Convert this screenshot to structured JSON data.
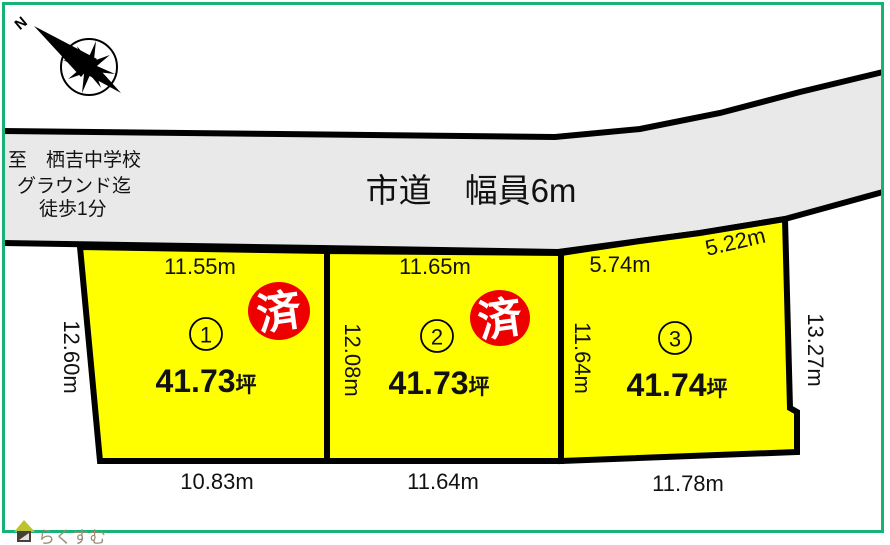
{
  "colors": {
    "frame_green": "#17b374",
    "plot_fill": "#ffff00",
    "road_fill": "#e9e9e9",
    "sold_red": "#ee0000",
    "line_black": "#000000",
    "watermark": "#9b8c77",
    "roof_green": "#b9c42e",
    "house_body": "#474034"
  },
  "compass": {
    "north_label": "N"
  },
  "road": {
    "label": "市道　幅員6m"
  },
  "access_note": {
    "line1": "至　栖吉中学校",
    "line2": "グラウンド迄",
    "line3": "徒歩1分"
  },
  "plots": [
    {
      "number": "1",
      "area_value": "41.73",
      "area_unit": "坪",
      "top_dim": "11.55m",
      "left_dim": "12.60m",
      "bottom_dim": "10.83m",
      "sold_label": "済"
    },
    {
      "number": "2",
      "area_value": "41.73",
      "area_unit": "坪",
      "top_dim": "11.65m",
      "left_dim": "12.08m",
      "bottom_dim": "11.64m",
      "sold_label": "済"
    },
    {
      "number": "3",
      "area_value": "41.74",
      "area_unit": "坪",
      "top_dim": "5.74m",
      "top_dim2": "5.22m",
      "left_dim": "11.64m",
      "right_dim": "13.27m",
      "bottom_dim": "11.78m"
    }
  ],
  "watermark": {
    "label": "らくすむ"
  }
}
